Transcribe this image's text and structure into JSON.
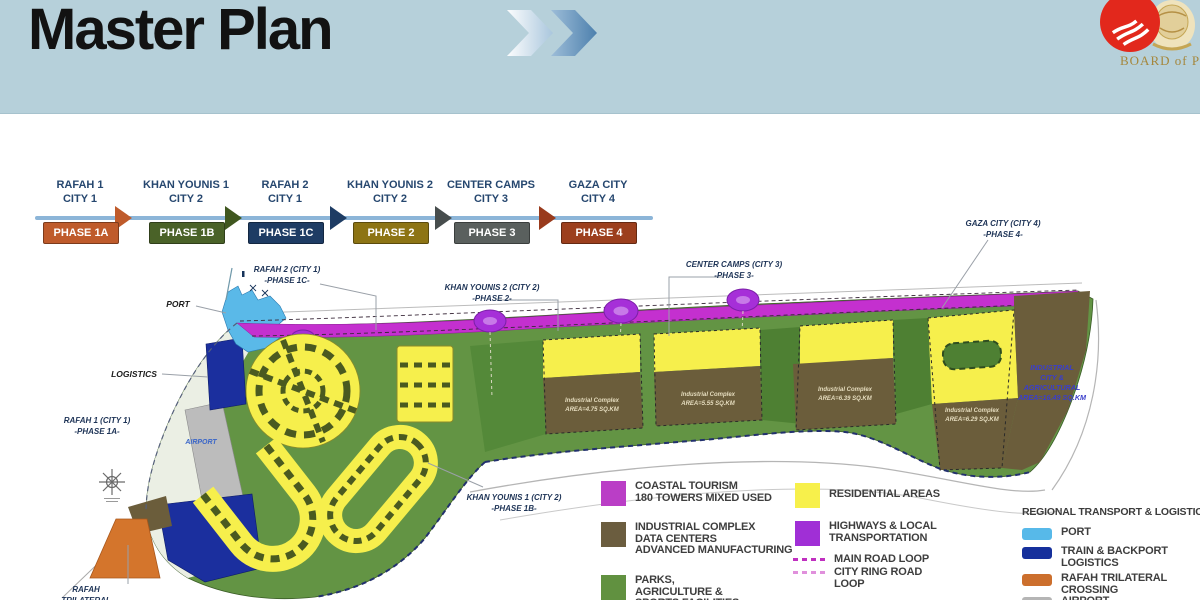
{
  "header": {
    "title": "Master Plan",
    "chevron_icon": "double-chevron-right",
    "background_color": "#b6d0da",
    "logo": {
      "text": "BOARD of P",
      "emblem": "red-circle-crest"
    }
  },
  "timeline": {
    "line_color": "#8cb5d8",
    "arrow_colors": [
      "#bf5b2b",
      "#40571f",
      "#1e3c64",
      "#474d4d",
      "#993a1c"
    ],
    "stages": [
      {
        "city": "RAFAH 1\nCITY 1",
        "phase": "PHASE 1A",
        "badge_color": "#bf5b2b"
      },
      {
        "city": "KHAN YOUNIS 1\nCITY 2",
        "phase": "PHASE 1B",
        "badge_color": "#4a6228"
      },
      {
        "city": "RAFAH 2\nCITY 1",
        "phase": "PHASE 1C",
        "badge_color": "#1e3c64"
      },
      {
        "city": "KHAN YOUNIS 2\nCITY 2",
        "phase": "PHASE 2",
        "badge_color": "#8d7414"
      },
      {
        "city": "CENTER CAMPS\nCITY 3",
        "phase": "PHASE 3",
        "badge_color": "#5a605e"
      },
      {
        "city": "GAZA CITY\nCITY 4",
        "phase": "PHASE 4",
        "badge_color": "#9c3f1d"
      }
    ]
  },
  "map": {
    "labels": {
      "port": "PORT",
      "logistics": "LOGISTICS",
      "airport": "AIRPORT",
      "rafah1": {
        "line1": "RAFAH 1 (CITY 1)",
        "line2": "-PHASE 1A-"
      },
      "rafah2": {
        "line1": "RAFAH 2 (CITY 1)",
        "line2": "-PHASE 1C-"
      },
      "khanyounis2": {
        "line1": "KHAN YOUNIS 2 (CITY 2)",
        "line2": "-PHASE 2-"
      },
      "centercamps": {
        "line1": "CENTER CAMPS (CITY 3)",
        "line2": "-PHASE 3-"
      },
      "gazacity": {
        "line1": "GAZA CITY (CITY 4)",
        "line2": "-PHASE 4-"
      },
      "khanyounis1": {
        "line1": "KHAN YOUNIS 1 (CITY 2)",
        "line2": "-PHASE 1B-"
      },
      "rafah_crossing": {
        "line1": "RAFAH",
        "line2": "TRILATERAL"
      }
    },
    "industrial_areas": [
      {
        "line1": "Industrial Complex",
        "line2": "AREA=4.75 SQ.KM"
      },
      {
        "line1": "Industrial Complex",
        "line2": "AREA=5.55 SQ.KM"
      },
      {
        "line1": "Industrial Complex",
        "line2": "AREA=6.39 SQ.KM"
      },
      {
        "line1": "Industrial Complex",
        "line2": "AREA=6.29 SQ.KM"
      }
    ],
    "industrial_city": {
      "line1": "INDUSTRIAL",
      "line2": "CITY &",
      "line3": "AGRICULTURAL",
      "line4": "AREA=16.49 SQ.KM"
    }
  },
  "legend_land_use": {
    "items": [
      {
        "key": "coastal-tourism",
        "color": "#ba3ec6",
        "label": "COASTAL TOURISM\n180 TOWERS MIXED USED"
      },
      {
        "key": "industrial-complex",
        "color": "#6b5d3f",
        "label": "INDUSTRIAL COMPLEX\nDATA CENTERS\nADVANCED MANUFACTURING"
      },
      {
        "key": "parks",
        "color": "#619140",
        "label": "PARKS,\nAGRICULTURE &\nSPORTS FACILITIES"
      },
      {
        "key": "residential",
        "color": "#f7f04b",
        "label": "RESIDENTIAL AREAS"
      },
      {
        "key": "highways",
        "color": "#a02fd6",
        "label": "HIGHWAYS & LOCAL\nTRANSPORTATION"
      },
      {
        "key": "main-road-loop",
        "color": "#c02fc0",
        "label": "MAIN ROAD LOOP"
      },
      {
        "key": "city-ring-road",
        "color": "#e090dc",
        "label": "CITY RING ROAD\nLOOP"
      }
    ]
  },
  "legend_transport": {
    "title": "REGIONAL TRANSPORT & LOGISTICS",
    "items": [
      {
        "key": "port",
        "color": "#57b9e9",
        "label": "PORT"
      },
      {
        "key": "train-backport",
        "color": "#16309c",
        "label": "TRAIN & BACKPORT\nLOGISTICS"
      },
      {
        "key": "rafah-crossing",
        "color": "#cc6f2d",
        "label": "RAFAH TRILATERAL\nCROSSING"
      },
      {
        "key": "airport",
        "color": "#b5b5b5",
        "label": "AIRPORT"
      }
    ]
  }
}
